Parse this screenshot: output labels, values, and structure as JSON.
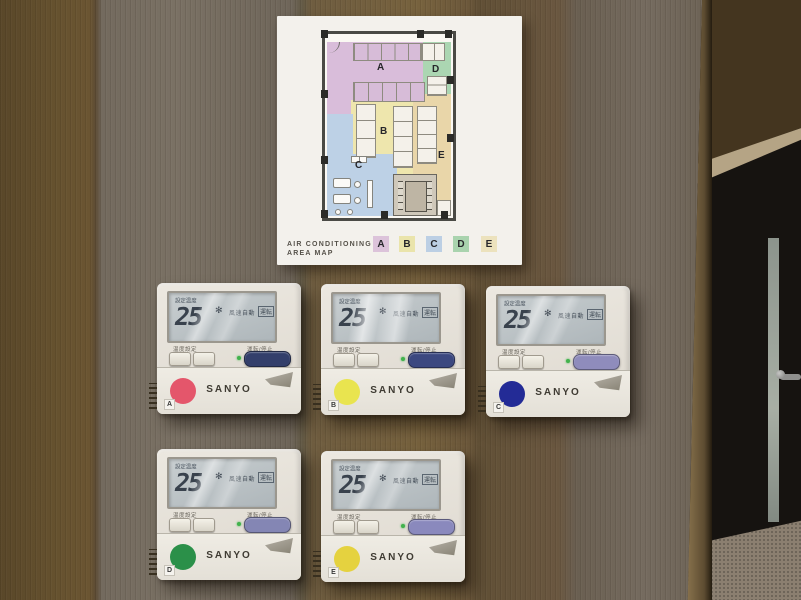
{
  "poster": {
    "title_line1": "AIR CONDITIONING",
    "title_line2": "AREA MAP",
    "zone_labels": {
      "A": "A",
      "B": "B",
      "C": "C",
      "D": "D",
      "E": "E"
    },
    "legend": [
      {
        "label": "A",
        "color": "#dcc3da"
      },
      {
        "label": "B",
        "color": "#eae4ab"
      },
      {
        "label": "C",
        "color": "#bccfe4"
      },
      {
        "label": "D",
        "color": "#a9d3ae"
      },
      {
        "label": "E",
        "color": "#ece2bd"
      }
    ],
    "zone_colors": {
      "A": "#d9bdda",
      "B": "#eee6ad",
      "C": "#bdd1e6",
      "D": "#abd6b2",
      "E": "#e9d6a9"
    }
  },
  "panels": [
    {
      "zone": "A",
      "brand": "SANYO",
      "dot_color": "#e4566b",
      "power_button_color": "#333f6b",
      "display": {
        "set_temp_label": "設定温度",
        "temperature": "25",
        "fan_mode": "風速自動",
        "status": "運転"
      },
      "controls": {
        "temp_label": "温度設定",
        "run_stop_label": "運転/停止"
      }
    },
    {
      "zone": "B",
      "brand": "SANYO",
      "dot_color": "#e9e44f",
      "power_button_color": "#3c4880",
      "display": {
        "set_temp_label": "設定温度",
        "temperature": "25",
        "fan_mode": "風速自動",
        "status": "運転"
      },
      "controls": {
        "temp_label": "温度設定",
        "run_stop_label": "運転/停止"
      }
    },
    {
      "zone": "C",
      "brand": "SANYO",
      "dot_color": "#232b96",
      "power_button_color": "#8f8cbc",
      "display": {
        "set_temp_label": "設定温度",
        "temperature": "25",
        "fan_mode": "風速自動",
        "status": "運転"
      },
      "controls": {
        "temp_label": "温度設定",
        "run_stop_label": "運転/停止"
      }
    },
    {
      "zone": "D",
      "brand": "SANYO",
      "dot_color": "#2b9049",
      "power_button_color": "#8486b4",
      "display": {
        "set_temp_label": "設定温度",
        "temperature": "25",
        "fan_mode": "風速自動",
        "status": "運転"
      },
      "controls": {
        "temp_label": "温度設定",
        "run_stop_label": "運転/停止"
      }
    },
    {
      "zone": "E",
      "brand": "SANYO",
      "dot_color": "#e5d23f",
      "power_button_color": "#8a89bd",
      "display": {
        "set_temp_label": "設定温度",
        "temperature": "25",
        "fan_mode": "風速自動",
        "status": "運転"
      },
      "controls": {
        "temp_label": "温度設定",
        "run_stop_label": "運転/停止"
      }
    }
  ]
}
